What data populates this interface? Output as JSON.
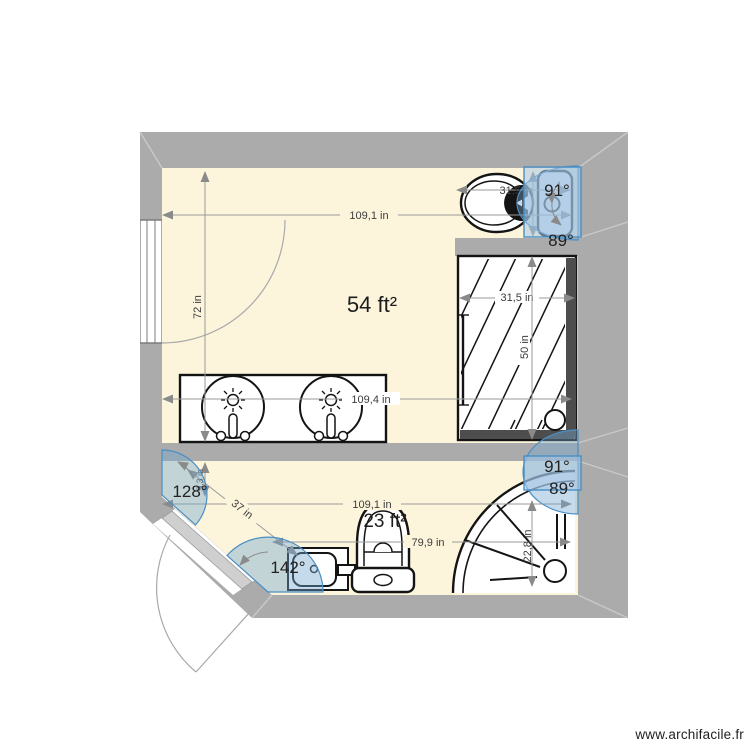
{
  "app": {
    "watermark": "www.archifacile.fr"
  },
  "plan": {
    "unit": "in",
    "rooms": {
      "top": {
        "area_label": "54 ft²"
      },
      "bottom": {
        "area_label": "23 ft²"
      }
    },
    "dimensions": {
      "top_room_width": "109,1 in",
      "top_room_height": "72 in",
      "toilet_alcove_width": "31,5 in",
      "shower_width": "31,5 in",
      "shower_depth": "50 in",
      "vanity_span": "109,4 in",
      "bottom_room_width": "109,1 in",
      "bottom_wall_length": "79,9 in",
      "door_wall_length": "37 in",
      "corner_shower_depth": "22,8 in",
      "left_wall_stub": "9,3 in"
    },
    "angles": {
      "wall_top_right_a": "91°",
      "wall_top_right_b": "89°",
      "wall_mid_right_a": "91°",
      "wall_mid_right_b": "89°",
      "door_corner_a": "128°",
      "door_corner_b": "142°"
    },
    "colors": {
      "wall": "#ababab",
      "floor": "#fcf5dc",
      "accent_blue": "#4a8fc4",
      "selection_fill": "#bcd4ea",
      "fixture_stroke": "#141414",
      "dimension_gray": "#9a9a9a"
    }
  }
}
